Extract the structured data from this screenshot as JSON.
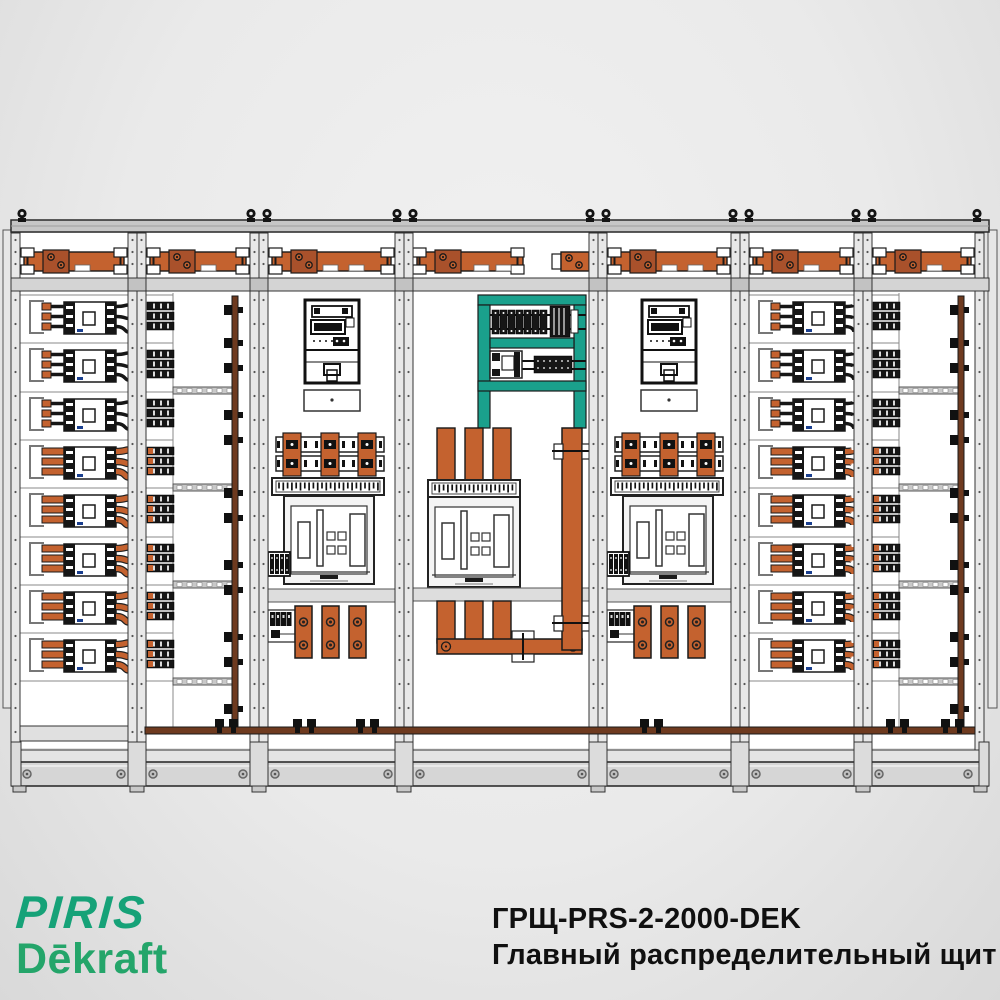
{
  "page": {
    "background_center": "#F0F0F0",
    "background_edge": "#D9D9D9"
  },
  "branding": {
    "line1": "PIRIS",
    "line2": "Dēkraft",
    "line1_color": "#16A278",
    "line2_color": "#24A56A"
  },
  "caption": {
    "line1": "ГРЩ-PRS-2-2000-DEK",
    "line2": "Главный распределительный щит",
    "color": "#101010"
  },
  "drawing": {
    "type": "switchboard-front-view",
    "colors": {
      "busbar_orange": "#C4622F",
      "busbar_joint_orange": "#A9512B",
      "earth_copper": "#6E3A1F",
      "mount_frame_teal": "#1AA08C",
      "frame_gray": "#E8E8E8",
      "divider_gray": "#D4D4D4",
      "plinth_gray": "#D6D6D6",
      "outline": "#1A1A1A",
      "device_black": "#161616",
      "panel_white": "#FFFFFF"
    },
    "sections": [
      {
        "id": 1,
        "type": "outgoing-mccb-feeders",
        "rows": 8
      },
      {
        "id": 2,
        "type": "modular-distribution",
        "rows": 8
      },
      {
        "id": 3,
        "type": "metering-incomer-acb"
      },
      {
        "id": 4,
        "type": "bus-coupler-acb"
      },
      {
        "id": 5,
        "type": "metering-incomer-acb"
      },
      {
        "id": 6,
        "type": "outgoing-mccb-feeders",
        "rows": 8
      },
      {
        "id": 7,
        "type": "modular-distribution",
        "rows": 8
      }
    ]
  }
}
